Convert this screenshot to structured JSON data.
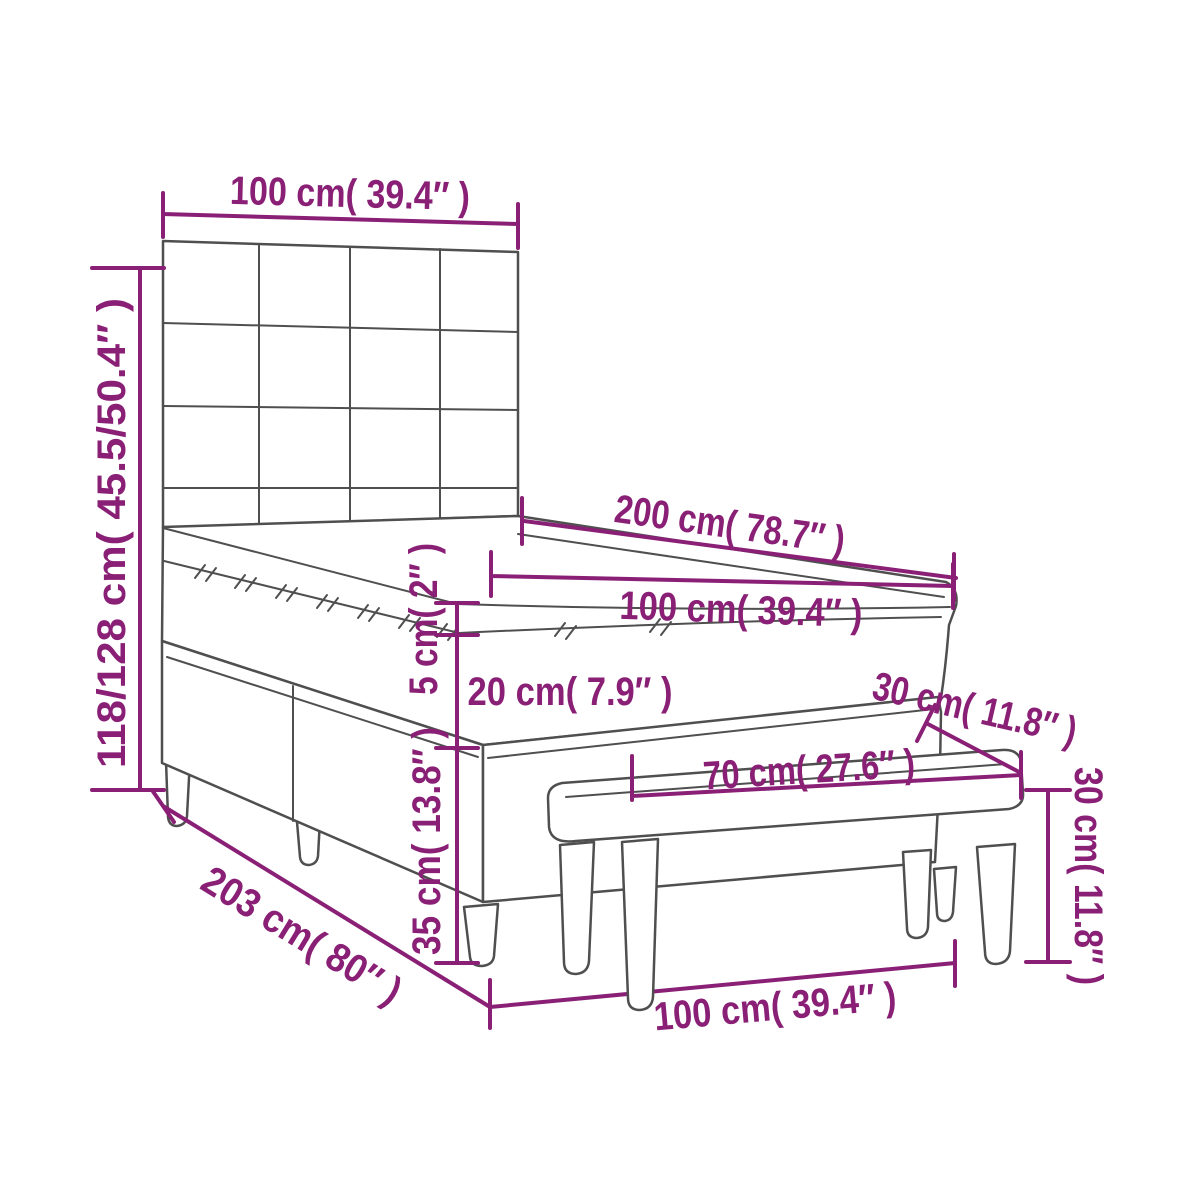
{
  "diagram": {
    "type": "furniture-dimension-diagram",
    "subject": "box spring bed with headboard, mattress topper and bench",
    "colors": {
      "dimension_annotation": "#8a2076",
      "line_art": "#4f4f4f",
      "background": "#ffffff"
    },
    "labels": {
      "headboard_width": {
        "text": "100 cm( 39.4″ )"
      },
      "total_height": {
        "text": "118/128 cm( 45.5/50.4″ )"
      },
      "bed_length": {
        "text": "200 cm( 78.7″ )"
      },
      "mattress_width": {
        "text": "100 cm( 39.4″ )"
      },
      "topper_thickness": {
        "text": "5 cm( 2″ )"
      },
      "mattress_thickness": {
        "text": "20 cm( 7.9″ )"
      },
      "box_spring_height": {
        "text": "35 cm( 13.8″ )"
      },
      "frame_length": {
        "text": "203 cm( 80″ )"
      },
      "frame_width": {
        "text": "100 cm( 39.4″ )"
      },
      "bench_depth": {
        "text": "30 cm( 11.8″ )"
      },
      "bench_height": {
        "text": "30 cm( 11.8″ )"
      },
      "bench_width": {
        "text": "70 cm( 27.6″ )"
      }
    }
  }
}
